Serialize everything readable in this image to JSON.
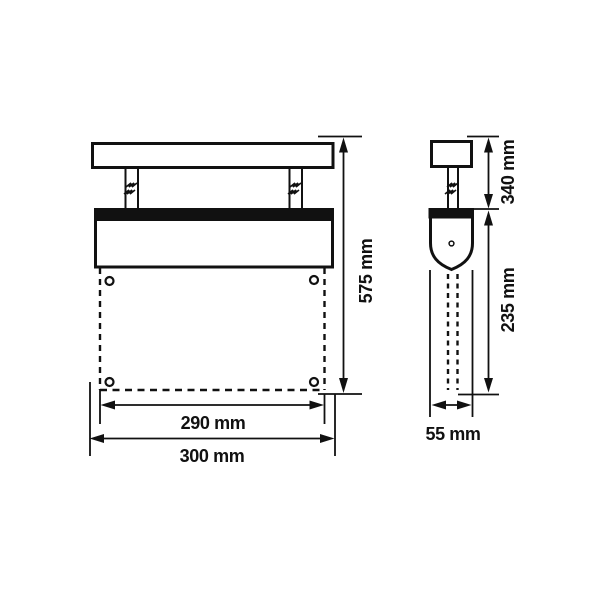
{
  "page": {
    "background": "#ffffff",
    "line_color": "#111111",
    "description": "Technical dimension drawing of a ceiling-suspended exit-sign luminaire, front and side views"
  },
  "drawing": {
    "views": {
      "front": {
        "name": "front-view",
        "labels": {
          "overall_height": "575 mm",
          "panel_width": "290 mm",
          "housing_width": "300 mm"
        }
      },
      "side": {
        "name": "side-view",
        "labels": {
          "suspension_height": "340 mm",
          "panel_height": "235 mm",
          "depth": "55 mm"
        }
      }
    }
  }
}
